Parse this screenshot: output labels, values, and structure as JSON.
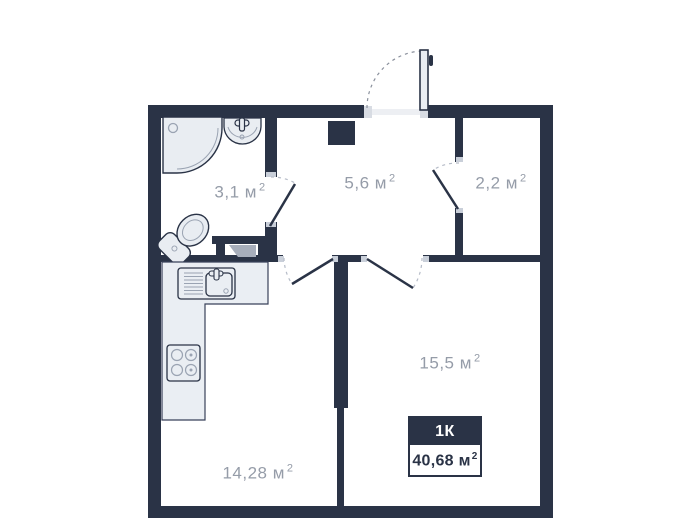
{
  "plan": {
    "colors": {
      "wall": "#2A3346",
      "fixture_fill": "#E9EDF2",
      "counter_fill": "#EAEEF3",
      "label_text": "#959CA8",
      "arc_dash": "#B6BCC8",
      "inner_stroke": "#9AA3B2"
    },
    "rooms": [
      {
        "id": "bathroom",
        "area": "3,1",
        "unit": "м",
        "sup": "2"
      },
      {
        "id": "hallway",
        "area": "5,6",
        "unit": "м",
        "sup": "2"
      },
      {
        "id": "wardrobe",
        "area": "2,2",
        "unit": "м",
        "sup": "2"
      },
      {
        "id": "living-room",
        "area": "15,5",
        "unit": "м",
        "sup": "2"
      },
      {
        "id": "kitchen",
        "area": "14,28",
        "unit": "м",
        "sup": "2"
      }
    ],
    "badge": {
      "type": "1К",
      "area": "40,68",
      "unit": "м",
      "sup": "2"
    }
  }
}
